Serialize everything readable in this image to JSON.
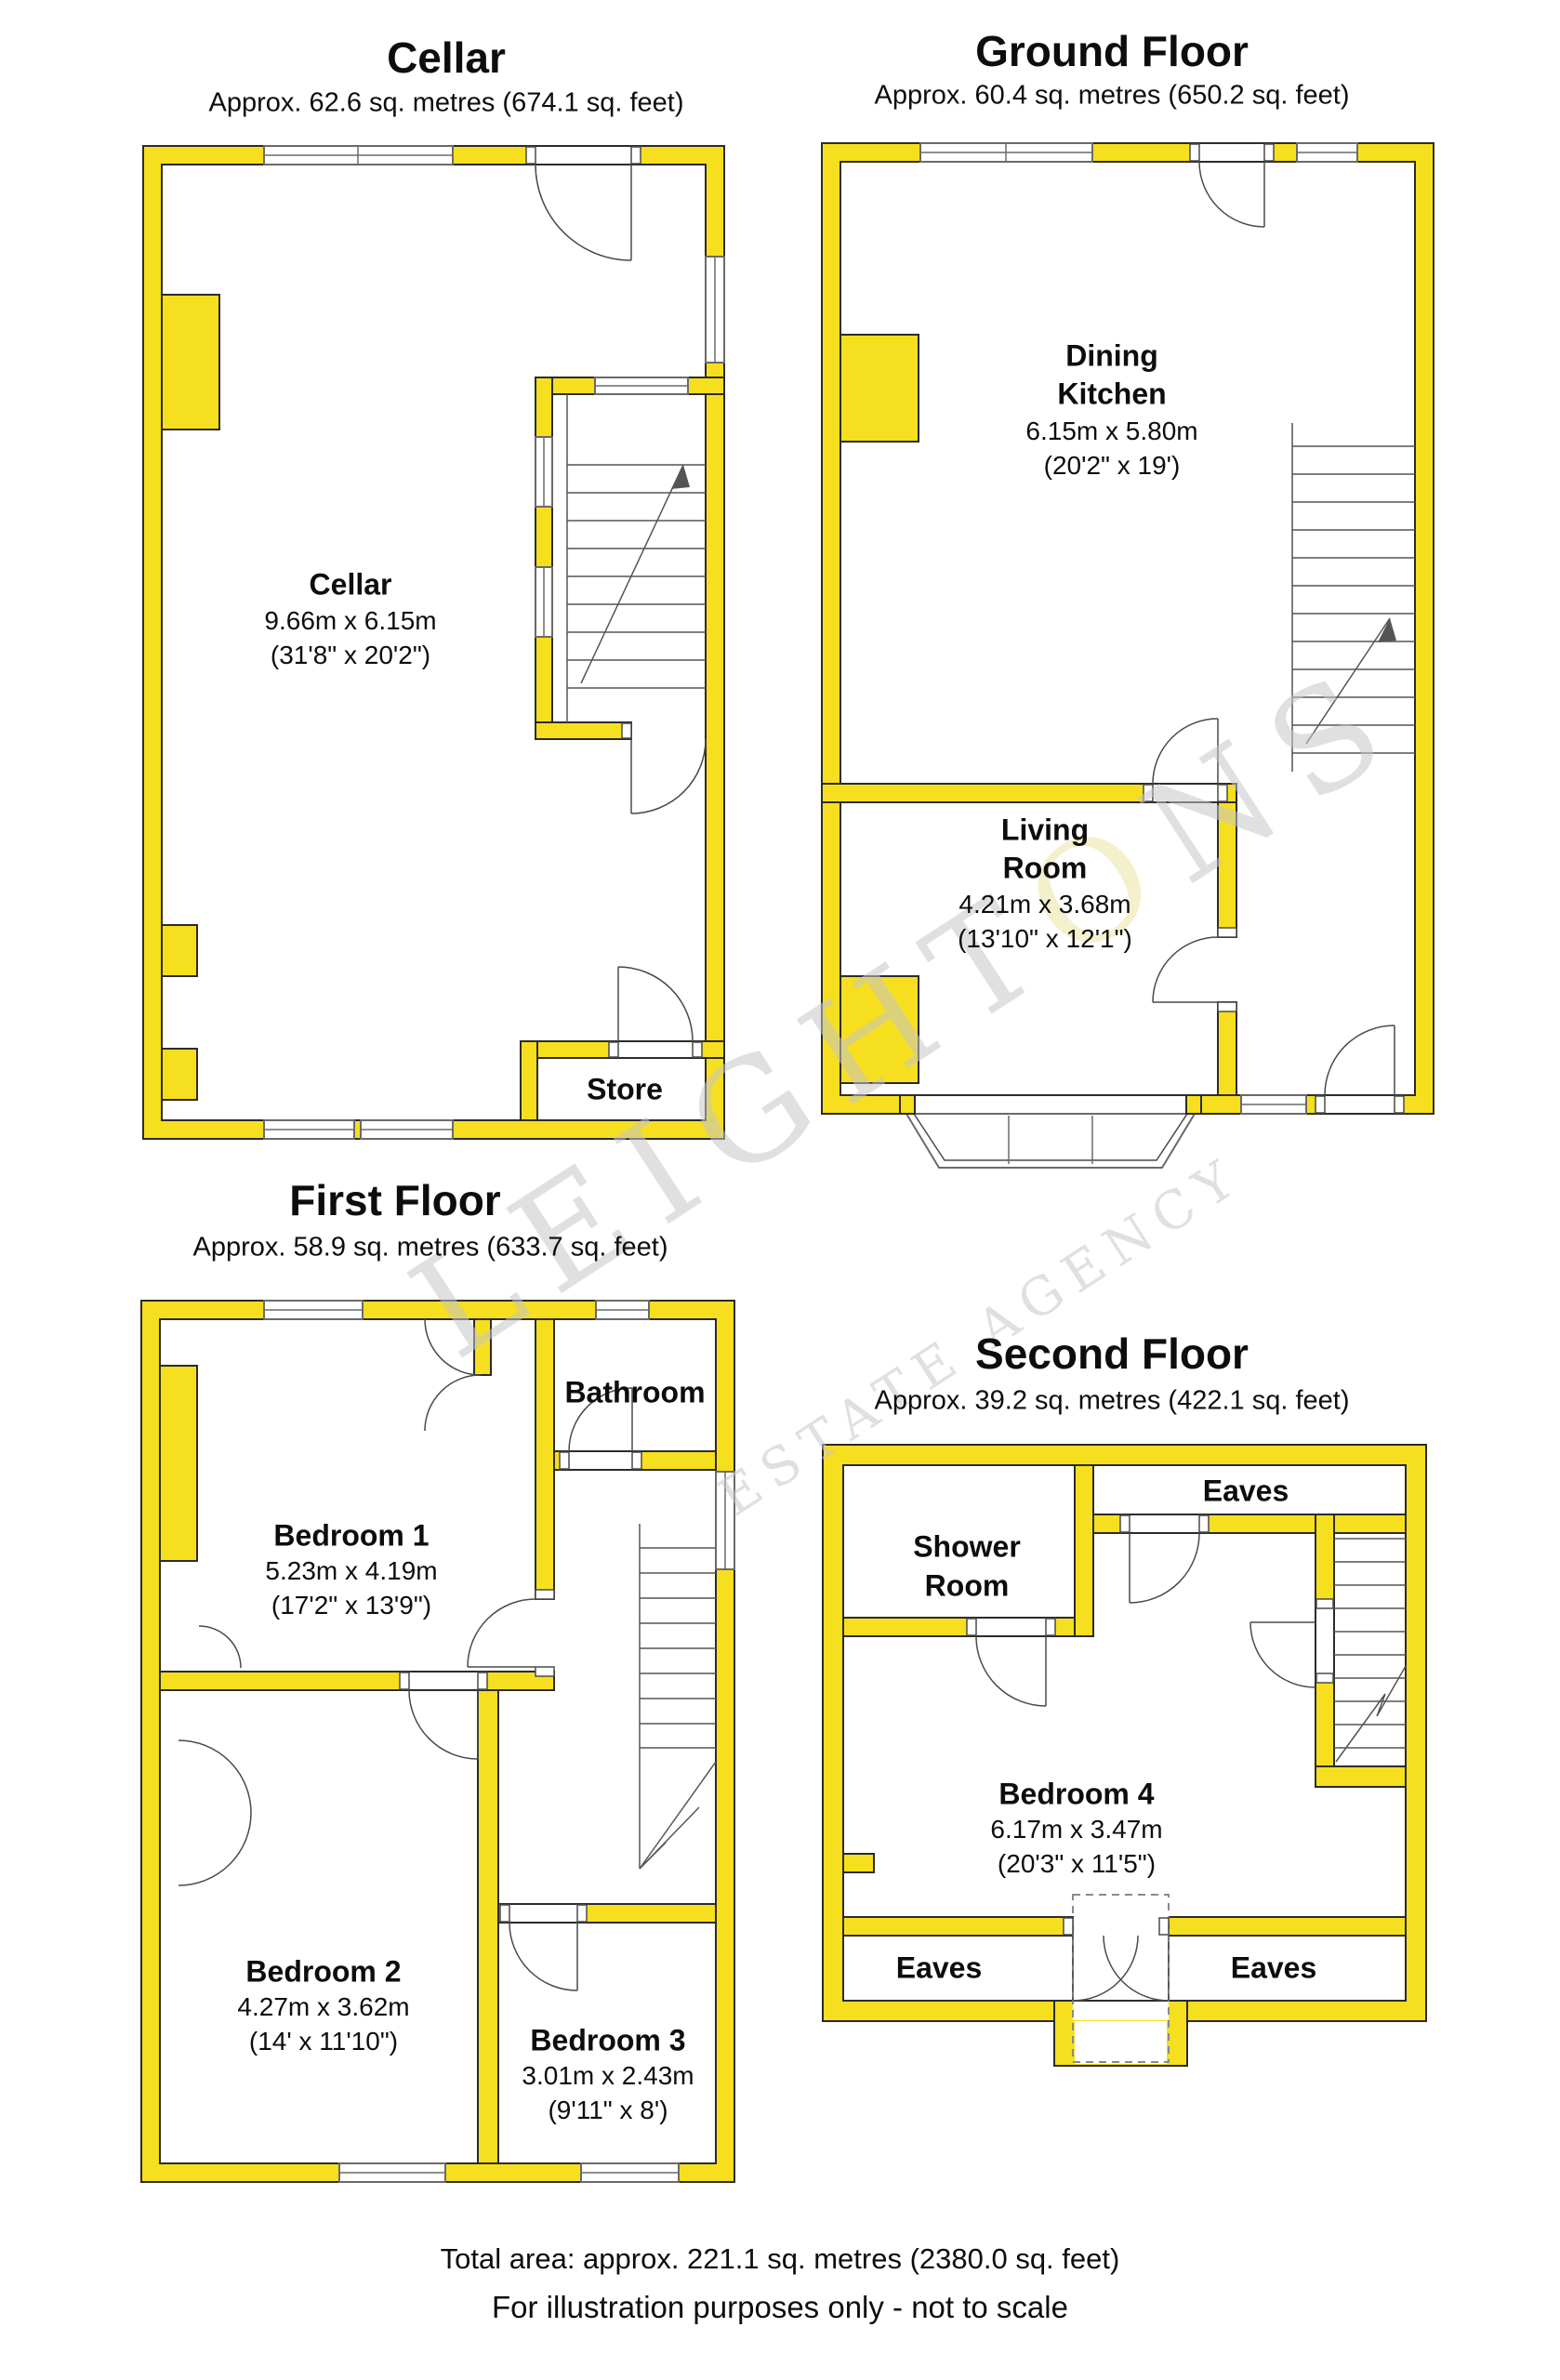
{
  "colors": {
    "wall": "#F6DF1E",
    "outline": "#2b2b2b",
    "wm": "#c7c7c7",
    "wmo": "#ece4a4"
  },
  "watermark": {
    "brand_pre": "LEIGHT",
    "brand_o": "O",
    "brand_post": "NS",
    "tagline": "ESTATE AGENCY"
  },
  "footer": {
    "total_area": "Total area: approx. 221.1 sq. metres (2380.0 sq. feet)",
    "disclaimer": "For illustration purposes only - not to scale"
  },
  "floors": {
    "cellar": {
      "title": "Cellar",
      "area": "Approx. 62.6 sq. metres (674.1 sq. feet)",
      "rooms": {
        "cellar": {
          "name": "Cellar",
          "metric": "9.66m x 6.15m",
          "imperial": "(31'8\" x 20'2\")"
        },
        "store": {
          "name": "Store"
        }
      }
    },
    "ground": {
      "title": "Ground Floor",
      "area": "Approx. 60.4 sq. metres (650.2 sq. feet)",
      "rooms": {
        "dining_kitchen": {
          "line1": "Dining",
          "line2": "Kitchen",
          "metric": "6.15m x 5.80m",
          "imperial": "(20'2\" x 19')"
        },
        "living_room": {
          "line1": "Living",
          "line2": "Room",
          "metric": "4.21m x 3.68m",
          "imperial": "(13'10\" x 12'1\")"
        }
      }
    },
    "first": {
      "title": "First Floor",
      "area": "Approx. 58.9 sq. metres (633.7 sq. feet)",
      "rooms": {
        "bedroom1": {
          "name": "Bedroom 1",
          "metric": "5.23m x 4.19m",
          "imperial": "(17'2\" x 13'9\")"
        },
        "bathroom": {
          "name": "Bathroom"
        },
        "bedroom2": {
          "name": "Bedroom 2",
          "metric": "4.27m x 3.62m",
          "imperial": "(14' x 11'10\")"
        },
        "bedroom3": {
          "name": "Bedroom 3",
          "metric": "3.01m x 2.43m",
          "imperial": "(9'11\" x 8')"
        }
      }
    },
    "second": {
      "title": "Second Floor",
      "area": "Approx. 39.2 sq. metres (422.1 sq. feet)",
      "rooms": {
        "shower_room": {
          "line1": "Shower",
          "line2": "Room"
        },
        "eaves_top": {
          "name": "Eaves"
        },
        "bedroom4": {
          "name": "Bedroom 4",
          "metric": "6.17m x 3.47m",
          "imperial": "(20'3\" x 11'5\")"
        },
        "eaves_left": {
          "name": "Eaves"
        },
        "eaves_right": {
          "name": "Eaves"
        }
      }
    }
  }
}
